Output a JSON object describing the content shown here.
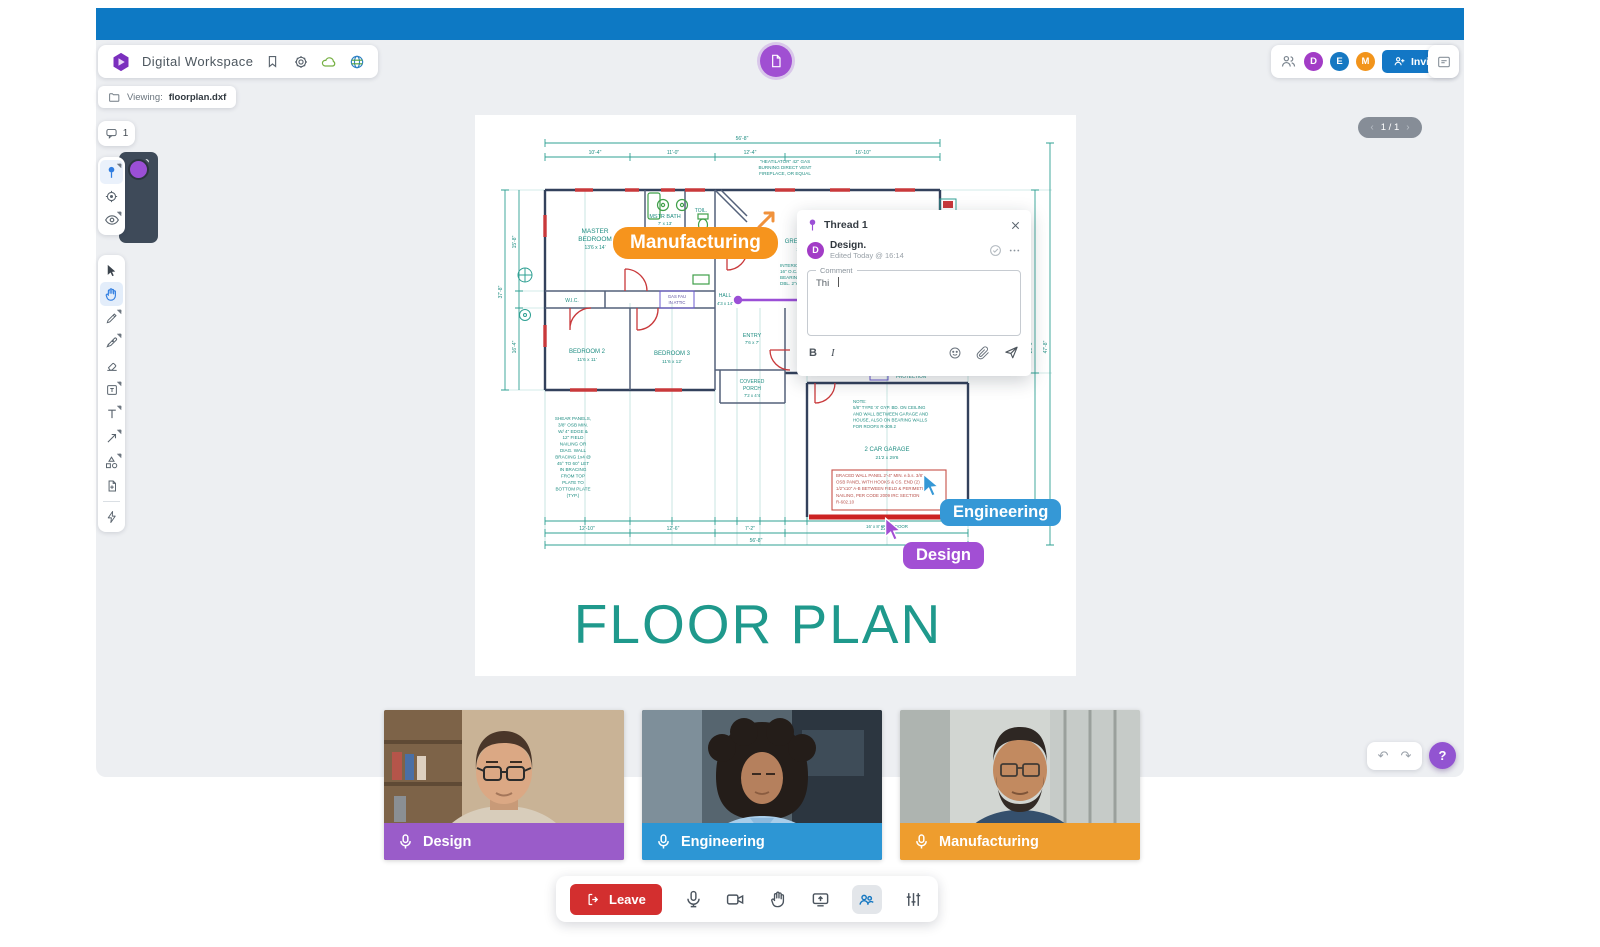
{
  "app": {
    "title": "Digital Workspace"
  },
  "topbar": {
    "color": "#0d79c4"
  },
  "header": {
    "icons": [
      "hexagon-logo",
      "bookmark",
      "settings-gear",
      "cloud-sync",
      "globe"
    ]
  },
  "viewing": {
    "label": "Viewing:",
    "file": "floorplan.dxf",
    "icon": "folder"
  },
  "presence": {
    "icon": "participants-group",
    "avatars": [
      {
        "initial": "D",
        "name": "Design",
        "color": "#a23cc6"
      },
      {
        "initial": "E",
        "name": "Engineering",
        "color": "#1678c2"
      },
      {
        "initial": "M",
        "name": "Manufacturing",
        "color": "#f2941b"
      }
    ],
    "invite_label": "Invite"
  },
  "comments": {
    "icon": "comment-bubble",
    "count": "1"
  },
  "pin_tools": {
    "items": [
      "comment-pin",
      "add-target",
      "visibility-eye"
    ],
    "active": "comment-pin",
    "swatch_color": "#9b4fd6"
  },
  "tools": {
    "items": [
      "select",
      "pan-hand",
      "pencil",
      "pen",
      "eraser",
      "note",
      "text",
      "arrow",
      "shapes",
      "add-file",
      "quick-actions"
    ],
    "active": "pan-hand"
  },
  "pager": {
    "prev": "‹",
    "label": "1 / 1",
    "next": "›"
  },
  "thread": {
    "title": "Thread 1",
    "author_initial": "D",
    "author": "Design.",
    "edited": "Edited Today @ 16:14",
    "field_label": "Comment",
    "field_value": "Thi",
    "bold_label": "B",
    "italic_label": "I"
  },
  "cursors": [
    {
      "user": "Manufacturing",
      "color": "#f6941d"
    },
    {
      "user": "Engineering",
      "color": "#3598d6"
    },
    {
      "user": "Design",
      "color": "#a24fd4"
    }
  ],
  "floorplan": {
    "title": "FLOOR PLAN",
    "rooms": {
      "master_l1": "MASTER",
      "master_l2": "BEDROOM",
      "master_dims": "13'6 x 14'",
      "bath": "MSTR BATH",
      "bath_dims": "7' x 13'",
      "toilet": "TOIL.",
      "wic": "W.I.C.",
      "hall": "HALL",
      "hall_dims": "4'3 x 14'",
      "bed2": "BEDROOM 2",
      "bed2_dims": "11'6 x 11'",
      "bed3": "BEDROOM 3",
      "bed3_dims": "11'6 x 12'",
      "entry": "ENTRY",
      "entry_dims": "7'6 x 7'",
      "great": "GREAT ROOM",
      "great_dims": "19' x 23'",
      "porch_l1": "COVERED",
      "porch_l2": "PORCH",
      "porch_dims": "7'2 x 4'4",
      "garage": "2 CAR GARAGE",
      "garage_dims": "21'2 x 29'6",
      "protection": "PROTECTION",
      "gasfau": [
        "GAS FAU",
        "IN ATTIC"
      ],
      "garage_door": "16' x 8' OVHD DOOR"
    },
    "notes": {
      "fireplace": [
        "\"HEATILATOR\" 42\" GAS",
        "BURNING DIRECT VENT",
        "FIREPLACE, OR EQUAL"
      ],
      "interior": [
        "INTERIOR WALLS,",
        "16\" O.C. INTERSECT",
        "BEARING HEADERS",
        "DBL. 2\"x6\" FLAT"
      ],
      "shear": [
        "SHEAR PANELS,",
        "3/8\" OSB MIN.",
        "W/ 4\" EDGE &",
        "12\" FIELD",
        "NAILING OR",
        "DIAG. WALL",
        "BRACING 1x4 @",
        "45° TO 60° LET",
        "IN BRACING",
        "FROM TOP",
        "PLATE TO",
        "BOTTOM PLATE",
        "(TYP.)"
      ],
      "garage_note": [
        "NOTE:",
        "5/8\" TYPE 'X' GYP. BD. ON CEILING",
        "AND WALL BETWEEN GARAGE AND",
        "HOUSE, ALSO ON BEARING WALLS",
        "FOR ROOFS R-309.2"
      ],
      "braced": [
        "BRACED WALL PANEL 2'-4\" MIN. e.b.s. 3/8\"",
        "OSB PANEL WITH HOOKS & CS. END (2)",
        "1/2\"x10\" A-B BETWEEN FIELD & PERIMETER",
        "NAILING, PER CODE 2009 IRC SECTION",
        "R-602.10"
      ]
    },
    "dims": {
      "top_total": "56'-8\"",
      "top": [
        "10'-4\"",
        "11'-0\"",
        "12'-4\"",
        "16'-10\""
      ],
      "bottom": [
        "12'-10\"",
        "12'-6\"",
        "7'-2\"",
        "22'-2\""
      ],
      "bottom_total": "56'-8\"",
      "left": [
        "15'-8\"",
        "16'-4\""
      ],
      "left_total": "37'-8\"",
      "right": "29'-6\"",
      "right_total": "47'-8\""
    }
  },
  "participants": [
    {
      "name": "Design",
      "bar_color": "#9a5cc9"
    },
    {
      "name": "Engineering",
      "bar_color": "#2d96d4"
    },
    {
      "name": "Manufacturing",
      "bar_color": "#ee9d2e"
    }
  ],
  "call_controls": {
    "leave_label": "Leave",
    "icons": [
      "microphone",
      "camera",
      "raise-hand",
      "share-screen",
      "participants",
      "settings-sliders"
    ],
    "active": "participants"
  },
  "history": {
    "undo": "↶",
    "redo": "↷"
  },
  "help": {
    "label": "?"
  }
}
